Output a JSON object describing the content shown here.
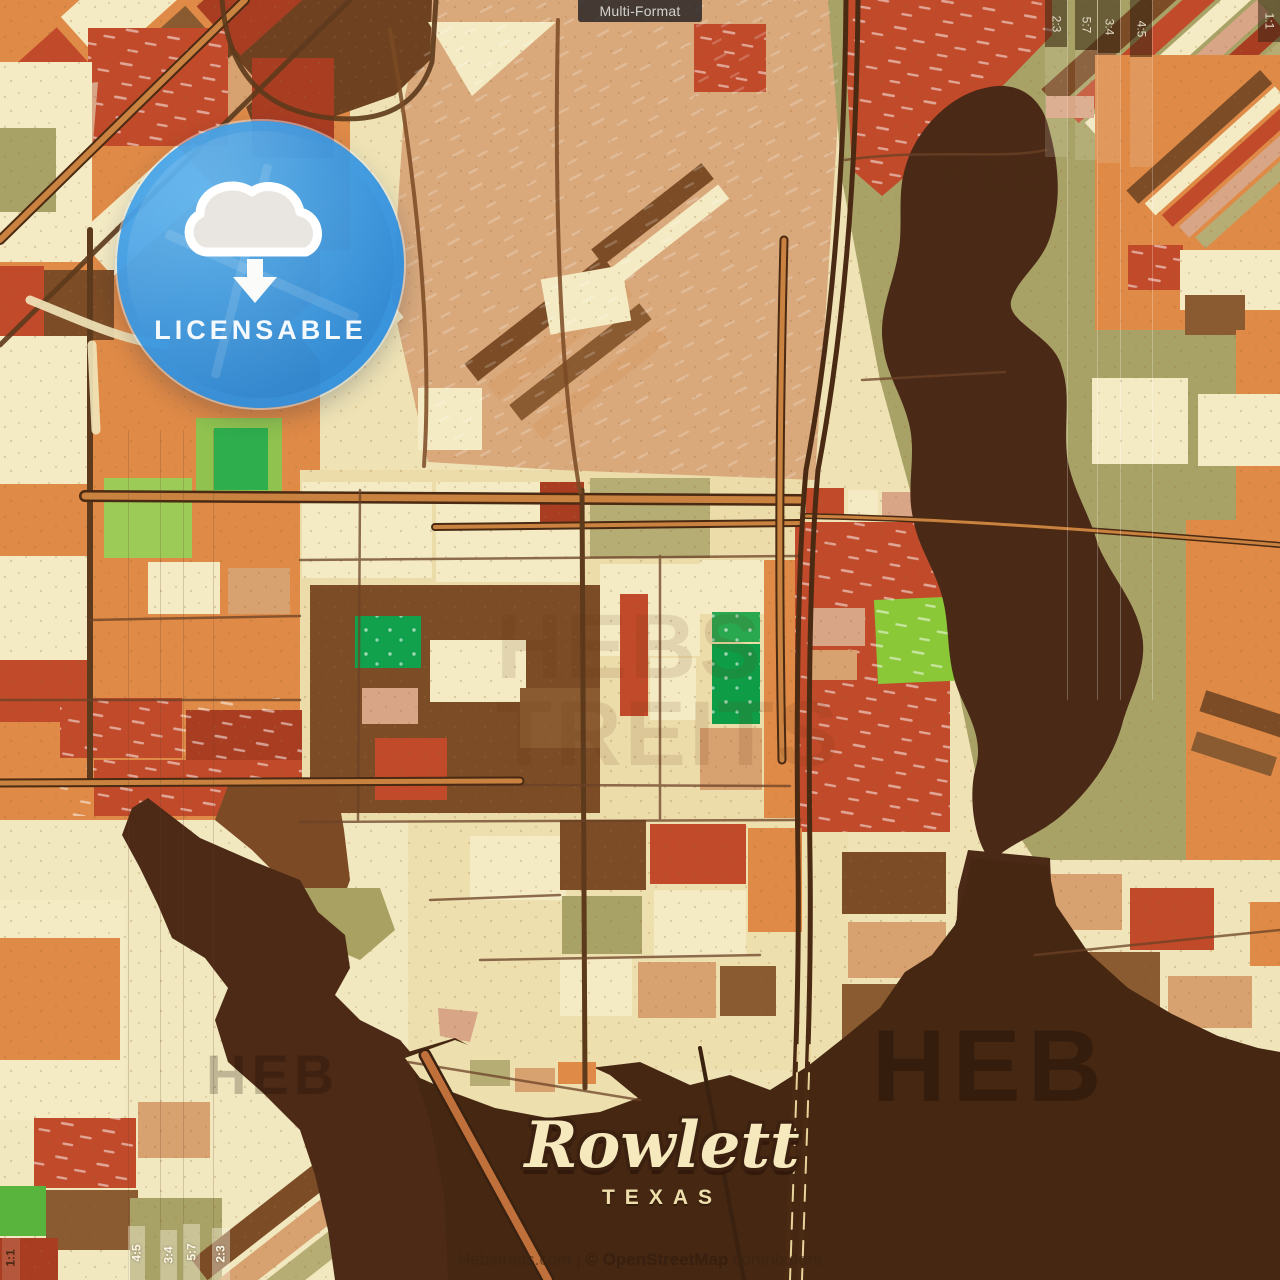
{
  "product": {
    "format_tab": "Multi-Format",
    "badge": {
      "label": "LICENSABLE",
      "icon": "cloud-download-icon",
      "color": "#3f9fe8"
    },
    "crop_ratios": {
      "top_right": [
        "2:3",
        "5:7",
        "3:4",
        "4:5"
      ],
      "top_right_corner": "1:1",
      "bottom_left": [
        "4:5",
        "3:4",
        "5:7",
        "2:3"
      ],
      "bottom_left_corner": "1:1"
    }
  },
  "map": {
    "city": "Rowlett",
    "region": "TEXAS",
    "watermarks": {
      "top_right": "HEB",
      "top_right_suffix": "STREITS",
      "center_line1": "HEBS",
      "center_line2": "TREITS",
      "lake_left": "HEB",
      "lake_right": "HEB"
    }
  },
  "attribution": {
    "site": "Hebstreits.com",
    "separator": "|",
    "osm": "© OpenStreetMap",
    "contributors": "contributors"
  },
  "palette": {
    "cream": "#f2e7bd",
    "tan": "#d8a170",
    "pink": "#d9a587",
    "orange": "#df8a47",
    "red": "#c14a2a",
    "dark_red": "#a93d22",
    "brown": "#7b4c26",
    "light_brown": "#8a5a30",
    "olive": "#a9a267",
    "park_green": "#8ac838",
    "deep_green": "#0f9c46",
    "water_dark_brown": "#4a2917",
    "road_dark": "#4a2a12",
    "road_orange": "#c9823f",
    "badge_blue": "#3f9fe8"
  }
}
